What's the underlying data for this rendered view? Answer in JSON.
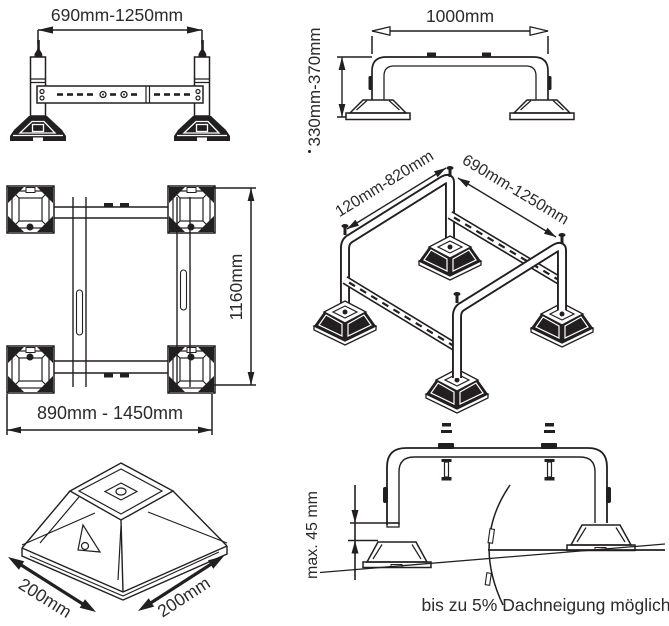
{
  "colors": {
    "line": "#231f20",
    "text": "#2b2b2b",
    "background": "#ffffff"
  },
  "views": {
    "front": {
      "width_label": "690mm-1250mm"
    },
    "side": {
      "width_label": "1000mm",
      "height_label": "330mm-370mm"
    },
    "top": {
      "depth_label": "1160mm",
      "width_label": "890mm - 1450mm"
    },
    "isometric": {
      "rail_label": "120mm-820mm",
      "width_label": "690mm-1250mm"
    },
    "foot": {
      "left_label": "200mm",
      "right_label": "200mm"
    },
    "slope": {
      "height_label": "max. 45 mm",
      "caption": "bis zu 5% Dachneigung möglich"
    }
  }
}
